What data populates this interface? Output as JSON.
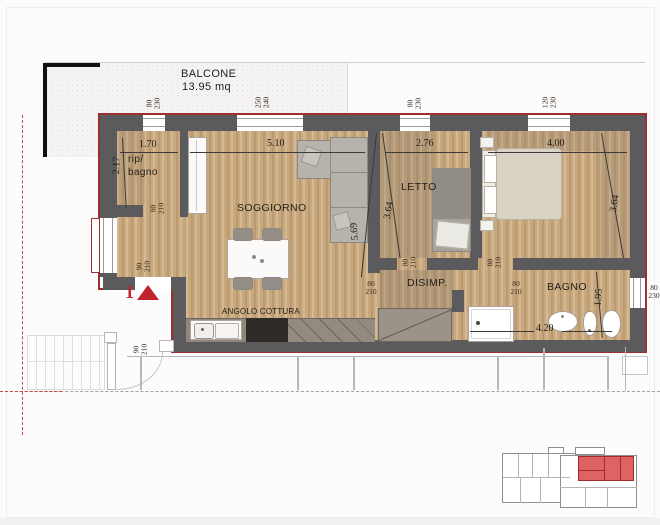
{
  "balcony": {
    "label": "BALCONE",
    "area": "13.95 mq"
  },
  "rooms": {
    "soggiorno": "SOGGIORNO",
    "letto": "LETTO",
    "disimp": "DISIMP.",
    "bagno": "BAGNO",
    "kitchen": "ANGOLO COTTURA",
    "rip_line1": "rip/",
    "rip_line2": "bagno"
  },
  "dims": {
    "rip_w": "1.70",
    "rip_h": "2.17",
    "sogg_w": "5.10",
    "sogg_diag": "5.69",
    "letto_w": "2.76",
    "letto_h": "3.64",
    "cam_w": "4.00",
    "cam_h": "3.64",
    "bagno_w": "4.20",
    "bagno_h": "1.95"
  },
  "openings": {
    "top1": {
      "w": "80",
      "h": "230"
    },
    "top2": {
      "w": "250",
      "h": "240"
    },
    "top3": {
      "w": "80",
      "h": "230"
    },
    "top4": {
      "w": "120",
      "h": "230"
    },
    "right_bagno": {
      "w": "80",
      "h": "230"
    },
    "door_rip": {
      "w": "80",
      "h": "210"
    },
    "door_entrance": {
      "w": "90",
      "h": "210"
    },
    "door_landing": {
      "w": "90",
      "h": "210"
    },
    "door_letto": {
      "w": "80",
      "h": "210"
    },
    "door_camera": {
      "w": "80",
      "h": "210"
    },
    "door_disimp": {
      "w": "80",
      "h": "210"
    },
    "door_bagno": {
      "w": "80",
      "h": "210"
    }
  },
  "marker": {
    "unit_number": "1"
  },
  "colors": {
    "wall": "#5b5a5c",
    "outline_red": "#9d2f2f",
    "floor_wood": "#c9a87d",
    "marker_red": "#c0232c",
    "keyplan_highlight": "#d94f4f"
  }
}
